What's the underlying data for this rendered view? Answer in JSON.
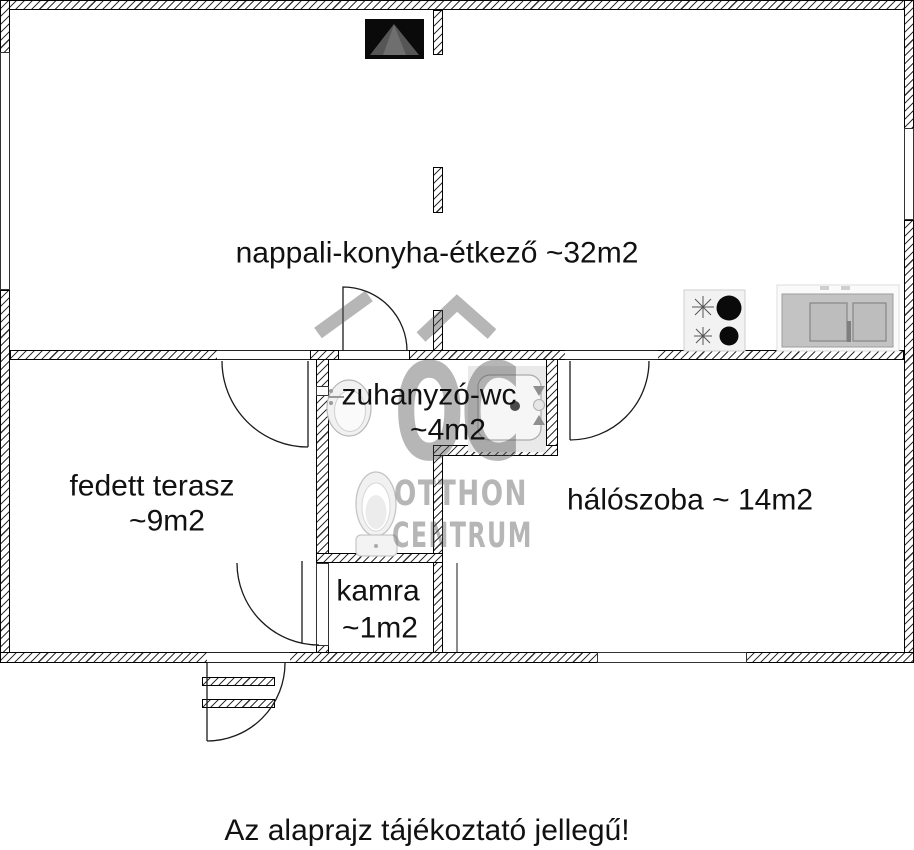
{
  "caption": "Az alaprajz tájékoztató jellegű!",
  "rooms": {
    "living": {
      "label": "nappali-konyha-étkező ~32m2"
    },
    "shower": {
      "label": "zuhanyzó-wc",
      "area": "~4m2"
    },
    "terrace": {
      "label": "fedett terasz",
      "area": "~9m2"
    },
    "bedroom": {
      "label": "hálószoba ~ 14m2"
    },
    "pantry": {
      "label": "kamra",
      "area": "~1m2"
    }
  },
  "watermark": {
    "monogram": "OC",
    "name_top": "OTTHON",
    "name_bottom": "CENTRUM",
    "color": "#5a5a5a"
  },
  "colors": {
    "wall_line": "#000000",
    "hatch": "#333333",
    "label_text": "#111111",
    "fixture_black": "#0a0a0a",
    "watermark_gray": "rgba(80,80,80,0.42)"
  },
  "fixtures": [
    "fireplace",
    "cooktop",
    "kitchen-sink",
    "shower-tray",
    "washbasin",
    "toilet",
    "entrance-steps"
  ]
}
